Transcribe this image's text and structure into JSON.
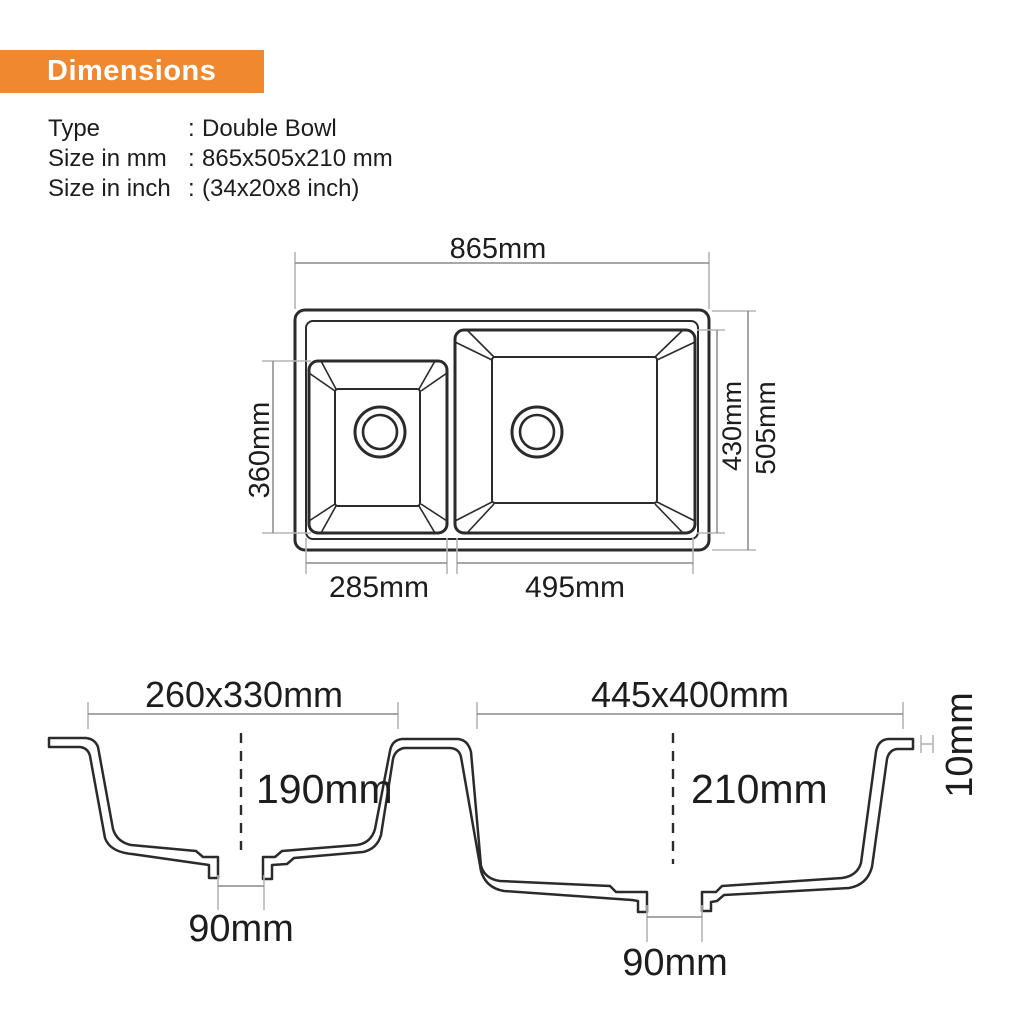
{
  "header": {
    "title": "Dimensions"
  },
  "specs": [
    {
      "label": "Type",
      "separator": ":",
      "value": "Double Bowl"
    },
    {
      "label": "Size in mm",
      "separator": ":",
      "value": "865x505x210 mm"
    },
    {
      "label": "Size in inch",
      "separator": ":",
      "value": "(34x20x8 inch)"
    }
  ],
  "top_view": {
    "overall_width": "865mm",
    "overall_depth": "505mm",
    "right_bowl_depth": "430mm",
    "left_bowl_depth": "360mm",
    "left_bowl_width": "285mm",
    "right_bowl_width": "495mm"
  },
  "cross_section": {
    "left_bowl_top": "260x330mm",
    "right_bowl_top": "445x400mm",
    "left_bowl_height": "190mm",
    "right_bowl_height": "210mm",
    "left_drain": "90mm",
    "right_drain": "90mm",
    "rim_thickness": "10mm"
  },
  "colors": {
    "accent": "#F0882F",
    "line": "#2b2b2b",
    "dimension_line": "#8a8a8a",
    "extension_line": "#b5b5b5",
    "text": "#1d1d1d",
    "background": "#ffffff"
  }
}
